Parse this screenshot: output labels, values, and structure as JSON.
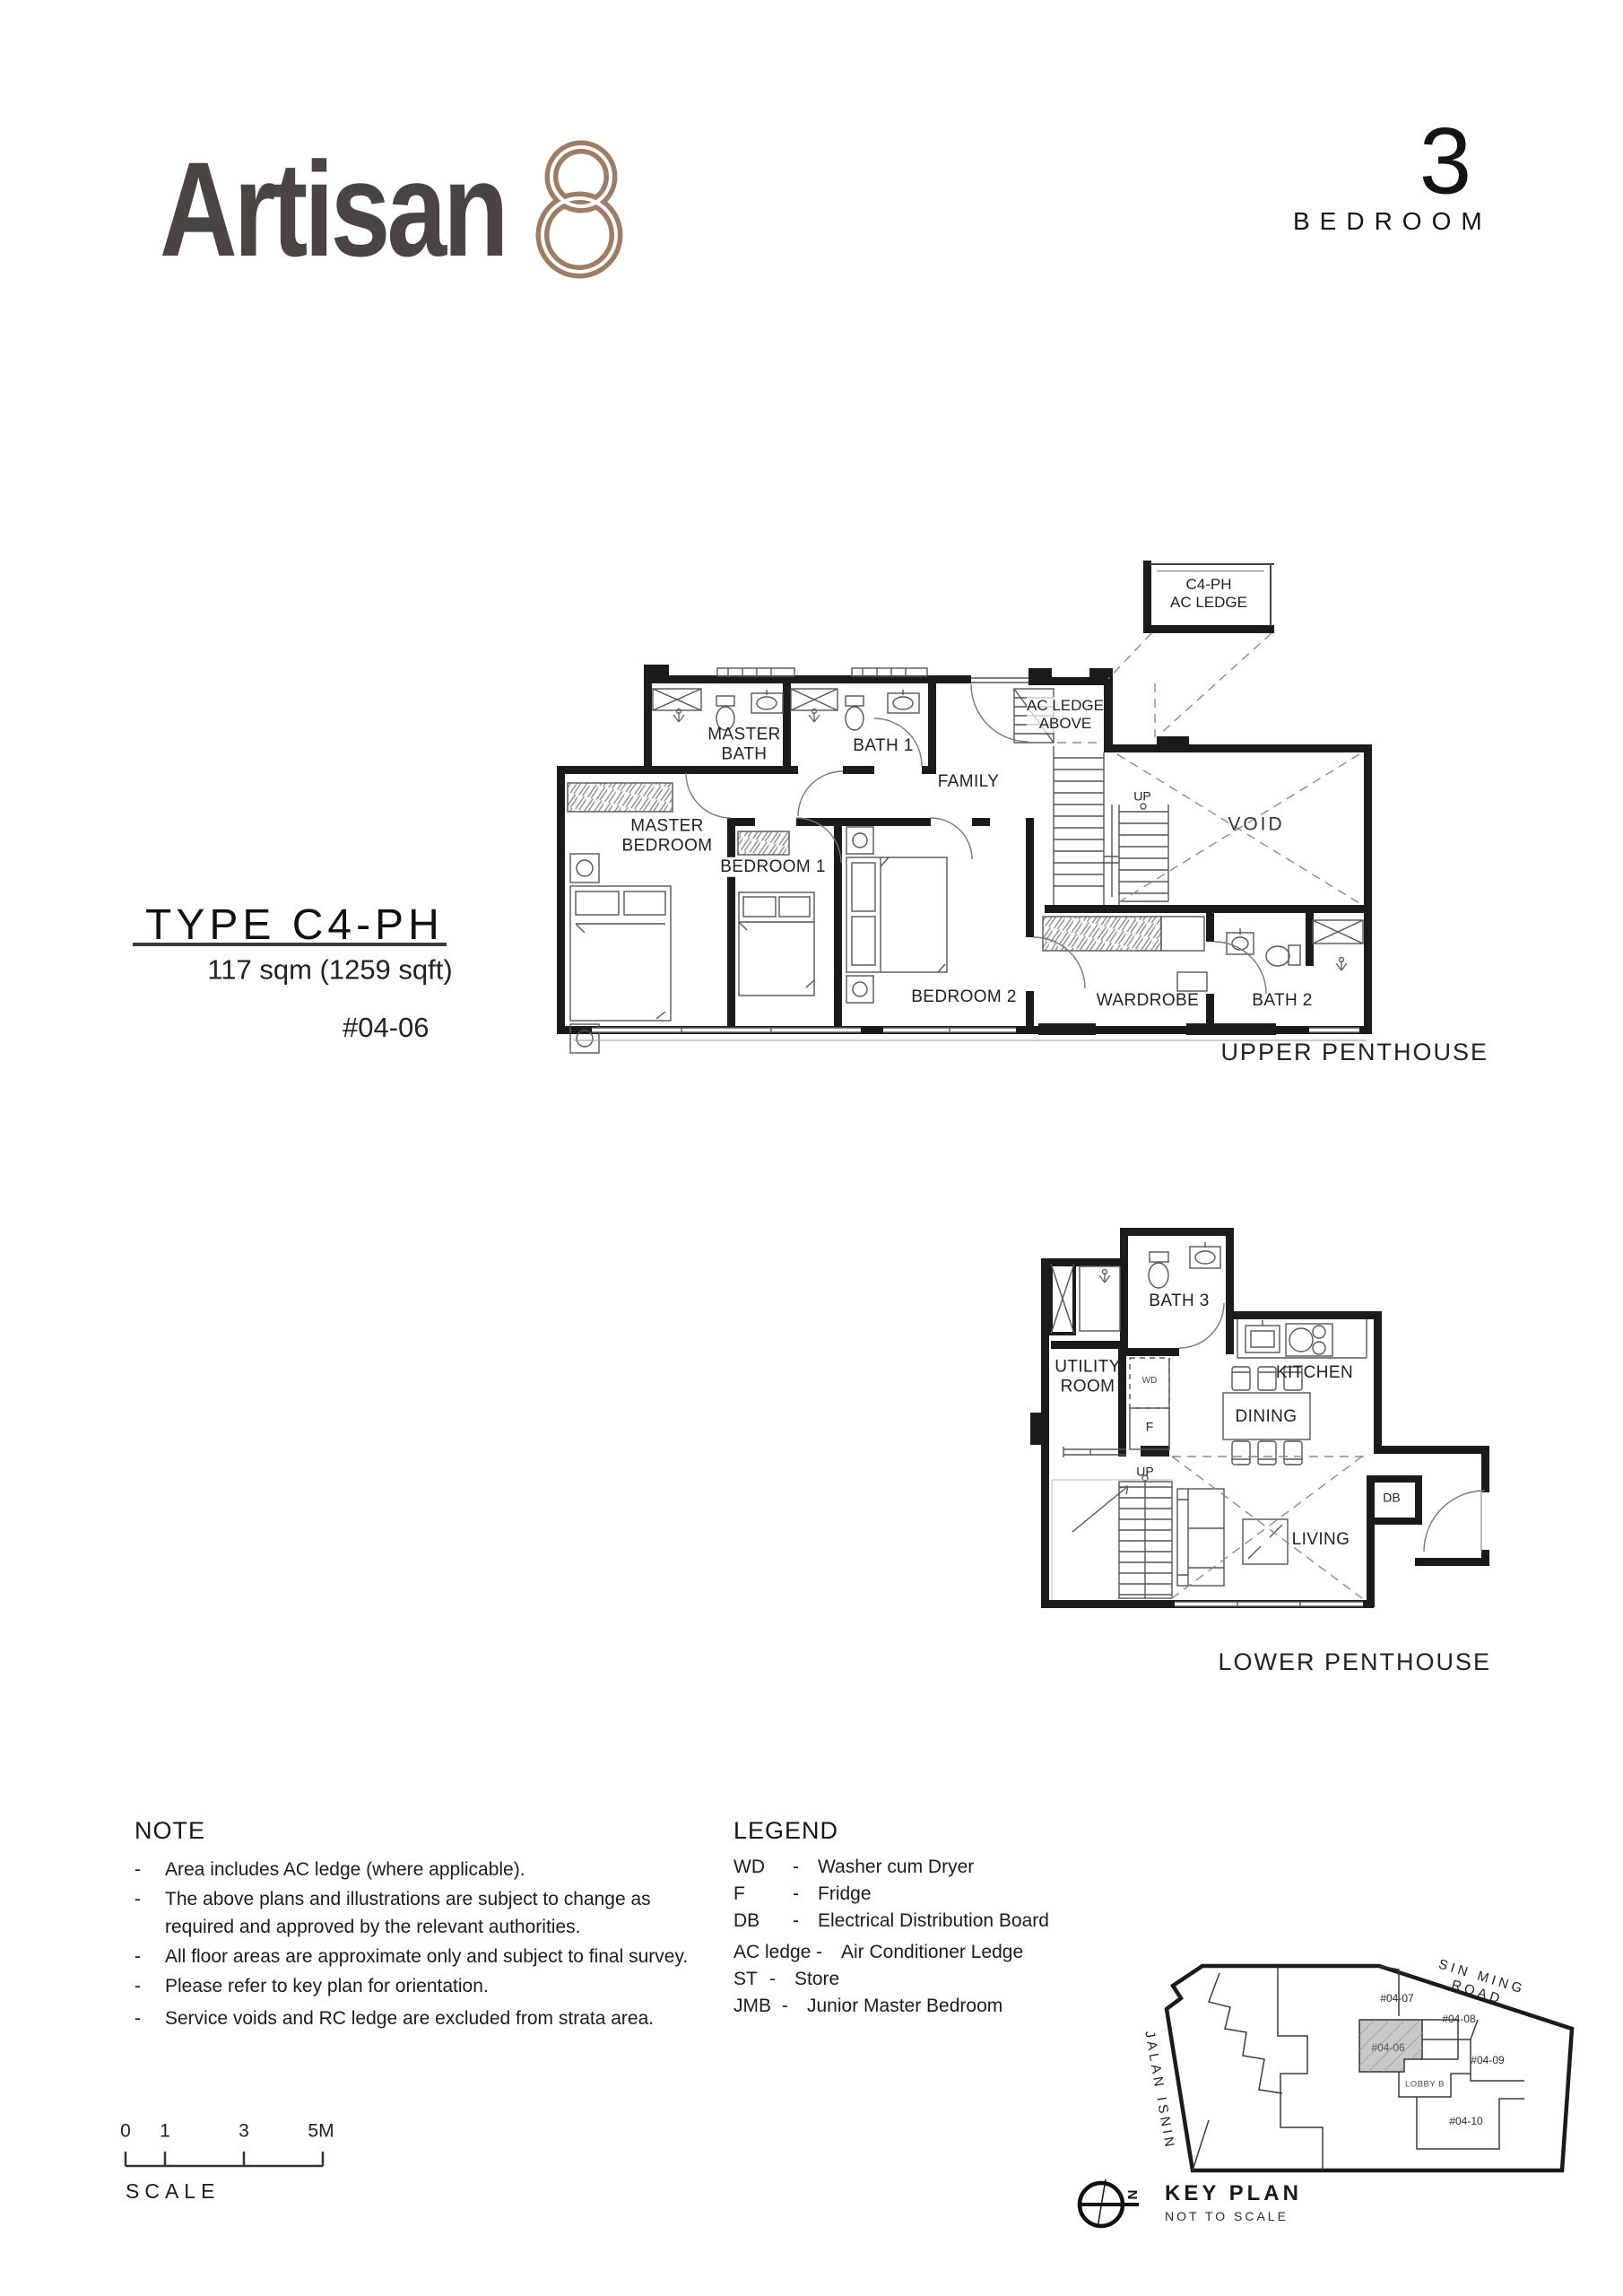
{
  "header": {
    "brand": "Artisan",
    "brand_mark": "8",
    "bedroom_count": "3",
    "bedroom_word": "BEDROOM"
  },
  "type_block": {
    "title": "TYPE C4-PH",
    "area": "117 sqm (1259 sqft)",
    "unit": "#04-06"
  },
  "upper_plan": {
    "caption": "UPPER PENTHOUSE",
    "rooms": {
      "ac_ledge_box": "C4-PH\nAC LEDGE",
      "ac_ledge_above": "AC LEDGE\nABOVE",
      "master_bath": "MASTER\nBATH",
      "bath1": "BATH 1",
      "family": "FAMILY",
      "master_bedroom": "MASTER\nBEDROOM",
      "bedroom1": "BEDROOM 1",
      "bedroom2": "BEDROOM 2",
      "wardrobe": "WARDROBE",
      "bath2": "BATH 2",
      "void": "VOID",
      "up": "UP"
    }
  },
  "lower_plan": {
    "caption": "LOWER PENTHOUSE",
    "rooms": {
      "bath3": "BATH 3",
      "utility": "UTILITY\nROOM",
      "wd": "WD",
      "fridge": "F",
      "kitchen": "KITCHEN",
      "dining": "DINING",
      "living": "LIVING",
      "db": "DB",
      "up": "UP"
    }
  },
  "note": {
    "title": "NOTE",
    "bullet": "-",
    "items": [
      "Area includes AC ledge (where applicable).",
      "The above plans and illustrations are subject to change as\nrequired and approved by the relevant authorities.",
      "All floor areas are approximate only and subject to final survey.",
      "Please refer to key plan for orientation.",
      "Service voids and RC ledge are excluded from strata area."
    ]
  },
  "legend": {
    "title": "LEGEND",
    "dash": "-",
    "entries": [
      {
        "abbr": "WD",
        "desc": "Washer cum Dryer"
      },
      {
        "abbr": "F",
        "desc": "Fridge"
      },
      {
        "abbr": "DB",
        "desc": "Electrical Distribution Board"
      },
      {
        "abbr": "AC ledge",
        "desc": "Air Conditioner Ledge"
      },
      {
        "abbr": "ST",
        "desc": "Store"
      },
      {
        "abbr": "JMB",
        "desc": "Junior Master Bedroom"
      }
    ]
  },
  "key_plan": {
    "title": "KEY PLAN",
    "subtitle": "NOT TO SCALE",
    "road_top": "SIN MING ROAD",
    "road_left": "JALAN ISNIN",
    "north": "N",
    "lobby": "LOBBY B",
    "units": [
      "#04-07",
      "#04-08",
      "#04-06",
      "#04-09",
      "#04-10"
    ]
  },
  "scale_bar": {
    "word": "SCALE",
    "ticks": [
      "0",
      "1",
      "3",
      "5M"
    ]
  },
  "colors": {
    "ink": "#1b1b1b",
    "thin": "#555555",
    "hatch": "#8a8a8a",
    "logo_text": "#4a4442",
    "logo_mark": "#9d7d66",
    "highlight_fill": "#c9c9c9"
  }
}
